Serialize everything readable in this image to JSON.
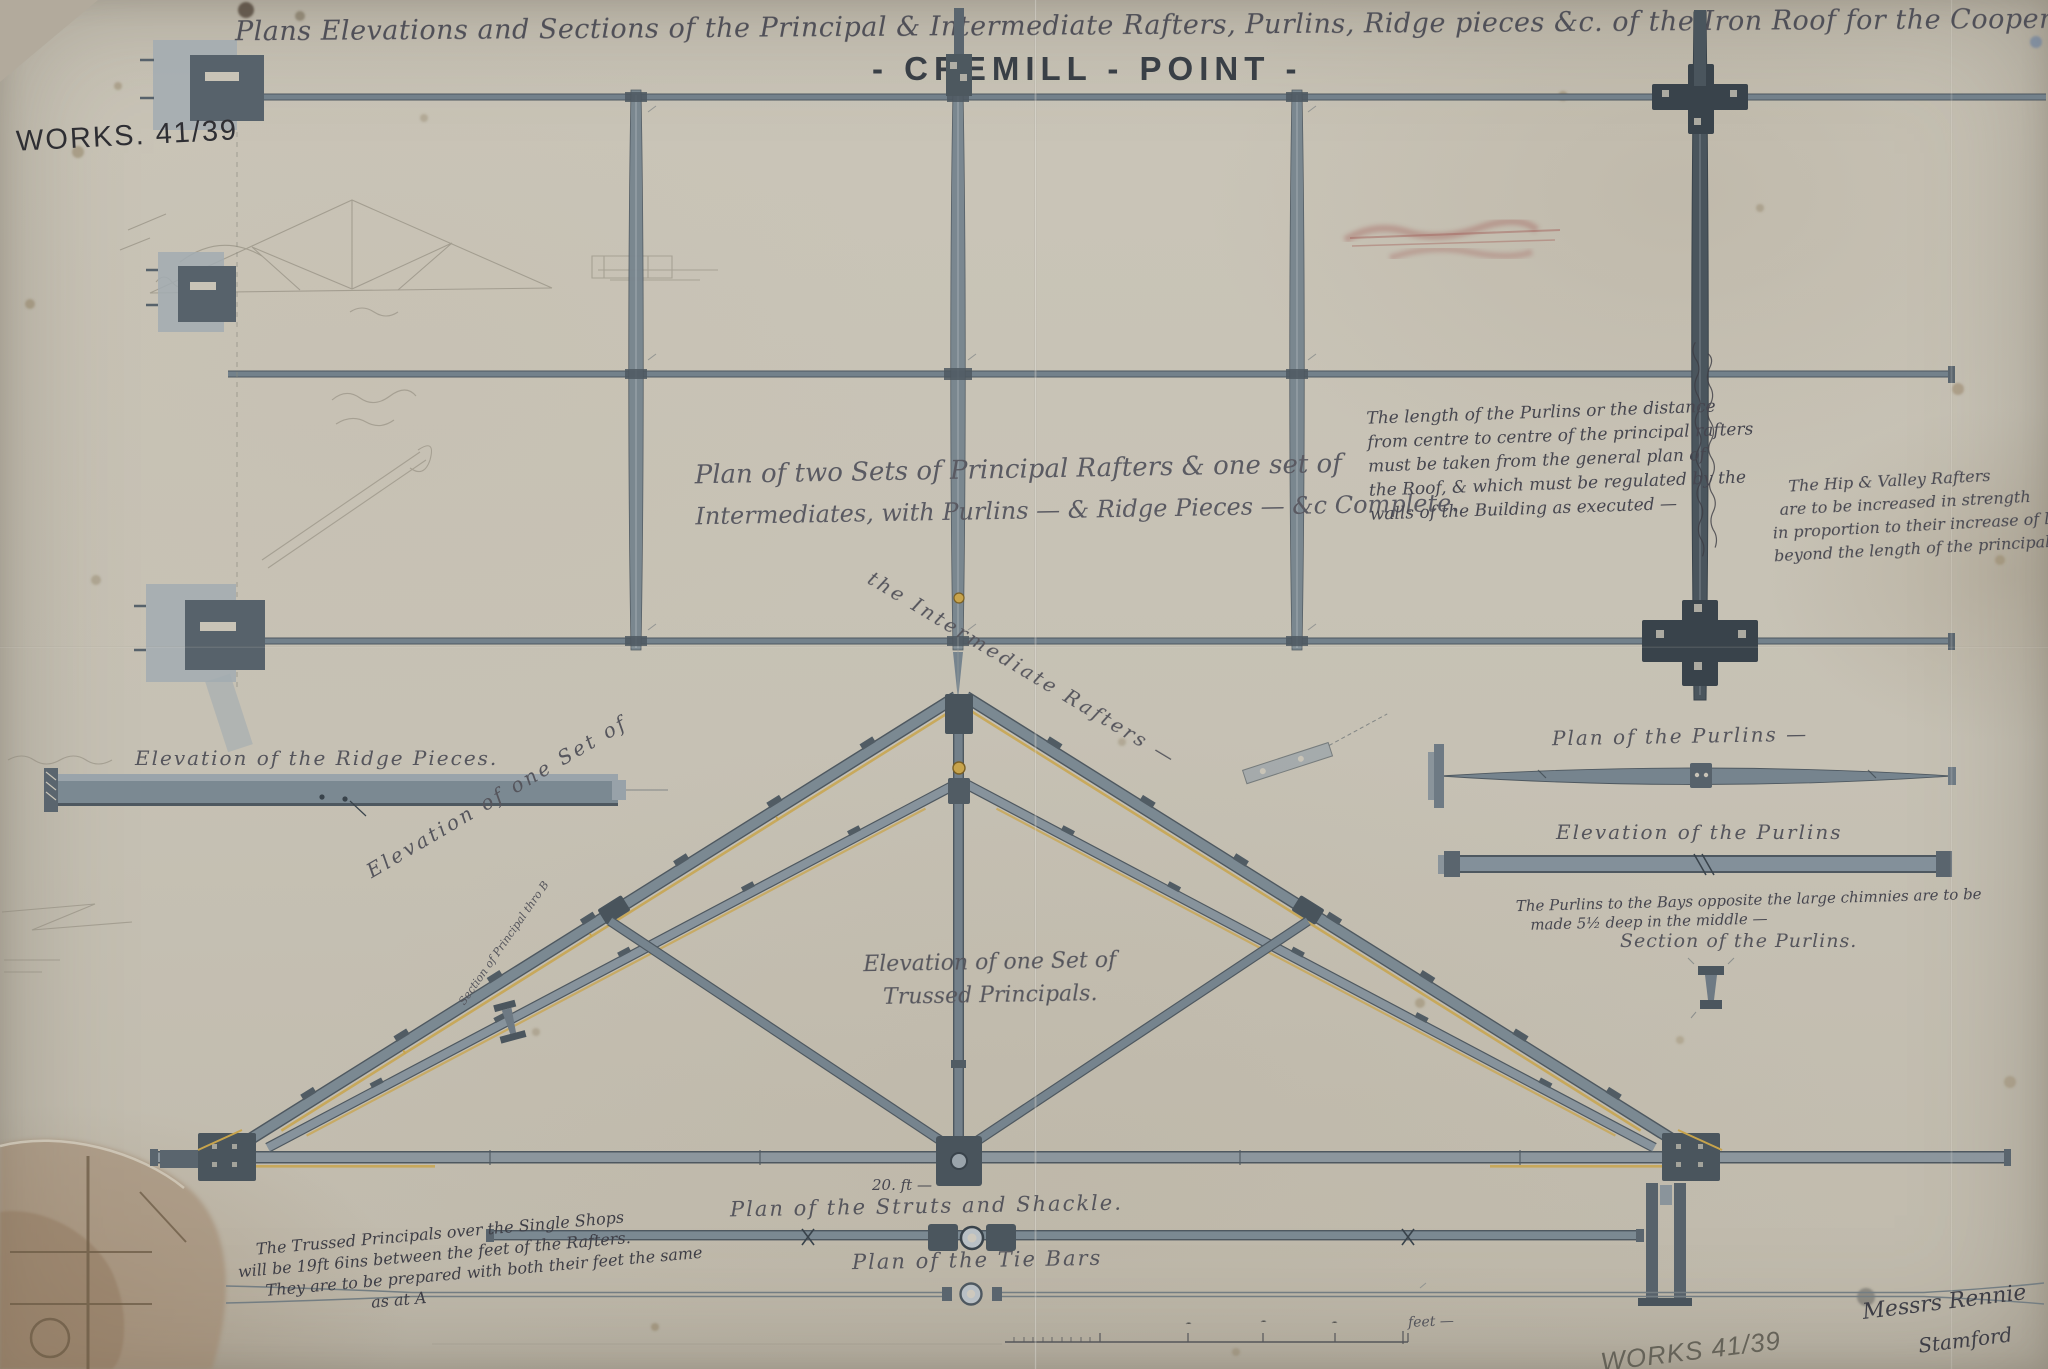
{
  "sheet": {
    "archive_ref_top": "WORKS. 41/39",
    "archive_ref_bottom": "WORKS 41/39",
    "title_script": "Plans Elevations and Sections of the Principal & Intermediate Rafters, Purlins, Ridge pieces &c. of the Iron Roof for the Coopers Shops —",
    "title_printed": "- CREMILL - POINT -",
    "signature": "Messrs Rennie",
    "signature_place": "Stamford"
  },
  "labels": {
    "plan_caption_line1": "Plan of two Sets of Principal Rafters & one set of",
    "plan_caption_line2": "Intermediates, with Purlins — & Ridge Pieces — &c Complete.",
    "ridge_elevation": "Elevation of the Ridge Pieces.",
    "truss_label_left": "Elevation of one Set of",
    "truss_label_right": "the Intermediate Rafters —",
    "principals_line1": "Elevation of one Set of",
    "principals_line2": "Trussed Principals.",
    "section_principal": "Section of Principal thro B",
    "purlins_plan": "Plan of the Purlins —",
    "purlins_elevation": "Elevation of the Purlins",
    "purlins_section": "Section of the Purlins.",
    "struts_plan": "Plan of the Struts and Shackle.",
    "tie_bars_plan": "Plan of the Tie Bars",
    "dimension_20ft": "20. ft —",
    "scale_feet": "feet —"
  },
  "notes": {
    "purlin_length_note": [
      "The length of the Purlins or the distance",
      "from centre to centre of the principal rafters",
      "must be taken from the general plan of",
      "the Roof, & which must be regulated by the",
      "walls of the Building as executed —"
    ],
    "hip_valley_note": [
      "The Hip & Valley Rafters",
      "are to be increased in strength",
      "in proportion to their increase of length",
      "beyond the length of the principal Rafters —"
    ],
    "purlin_depth_note": [
      "The Purlins to the Bays opposite the large chimnies are to be",
      "made 5½ deep in the middle —"
    ],
    "trussed_principals_note": [
      "The Trussed Principals over the Single Shops",
      "will be 19ft 6ins between the feet of the Rafters.",
      "They are to be prepared with both their feet the same",
      "as at A"
    ]
  },
  "colors": {
    "paper": "#c7c2b5",
    "iron_wash": "#7b8992",
    "iron_dark": "#49545c",
    "ochre_rod": "#c8a44c",
    "ink": "#4a4a50",
    "pencil": "#8b8578",
    "stain_brown": "#9c8267"
  }
}
